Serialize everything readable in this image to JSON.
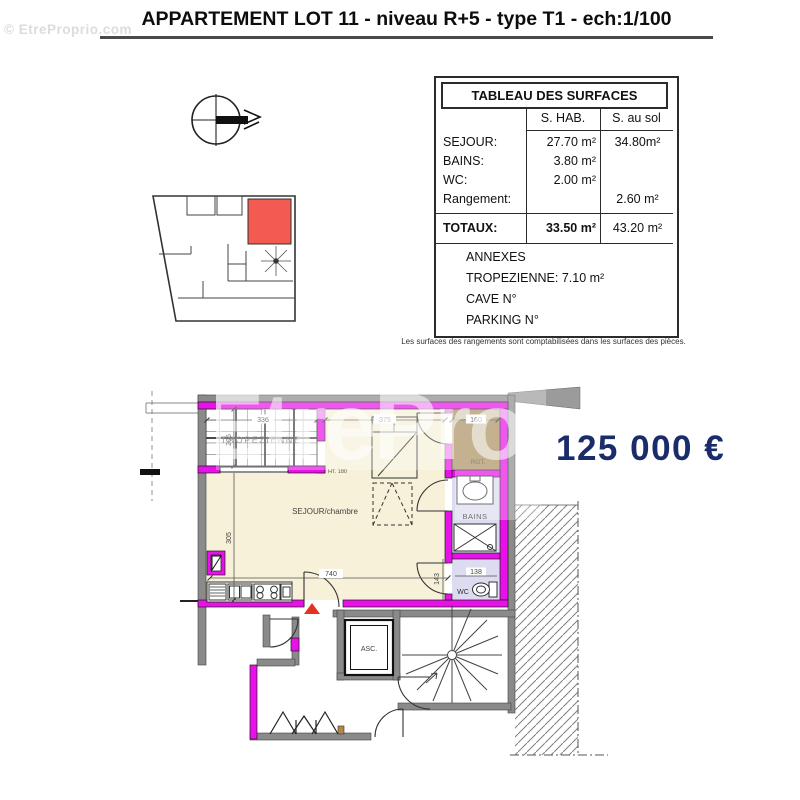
{
  "page": {
    "title": "APPARTEMENT LOT 11 - niveau R+5 - type T1 - ech:1/100",
    "corner_watermark": "© EtreProprio.com",
    "center_watermark": "EtreProprio",
    "price": "125 000 €"
  },
  "surfaces_table": {
    "title": "TABLEAU DES SURFACES",
    "columns": {
      "hab": "S. HAB.",
      "sol": "S. au sol"
    },
    "rows": [
      {
        "label": "SEJOUR:",
        "hab": "27.70 m²",
        "sol": "34.80m²"
      },
      {
        "label": "BAINS:",
        "hab": "3.80 m²",
        "sol": ""
      },
      {
        "label": "WC:",
        "hab": "2.00 m²",
        "sol": ""
      },
      {
        "label": "Rangement:",
        "hab": "",
        "sol": "2.60 m²"
      }
    ],
    "totals": {
      "label": "TOTAUX:",
      "hab": "33.50 m²",
      "sol": "43.20 m²"
    },
    "annexes": {
      "title": "ANNEXES",
      "lines": [
        "TROPEZIENNE: 7.10 m²",
        "CAVE N°",
        "PARKING N°"
      ]
    },
    "footnote": "Les surfaces des rangements sont comptabilisées dans les surfaces des pièces."
  },
  "plan": {
    "rooms": {
      "tropezienne": "TROPEZIENNE",
      "sejour": "SEJOUR/chambre",
      "rgt": "RGT.",
      "bains": "BAINS",
      "wc": "WC",
      "asc": "ASC."
    },
    "dims": {
      "d336": "336",
      "d205": "205",
      "d375": "375",
      "d160": "160",
      "ht180": "HT. 180",
      "d305": "305",
      "d740": "740",
      "d143": "143",
      "d138": "138"
    }
  },
  "colors": {
    "wall": "#e911e9",
    "sejour_fill": "#f6f1d8",
    "rgt_fill": "#a9905f",
    "bath_fill": "#dcdbf0",
    "highlight": "#f25a52",
    "arrow": "#e13222",
    "price": "#1b2c6b"
  }
}
